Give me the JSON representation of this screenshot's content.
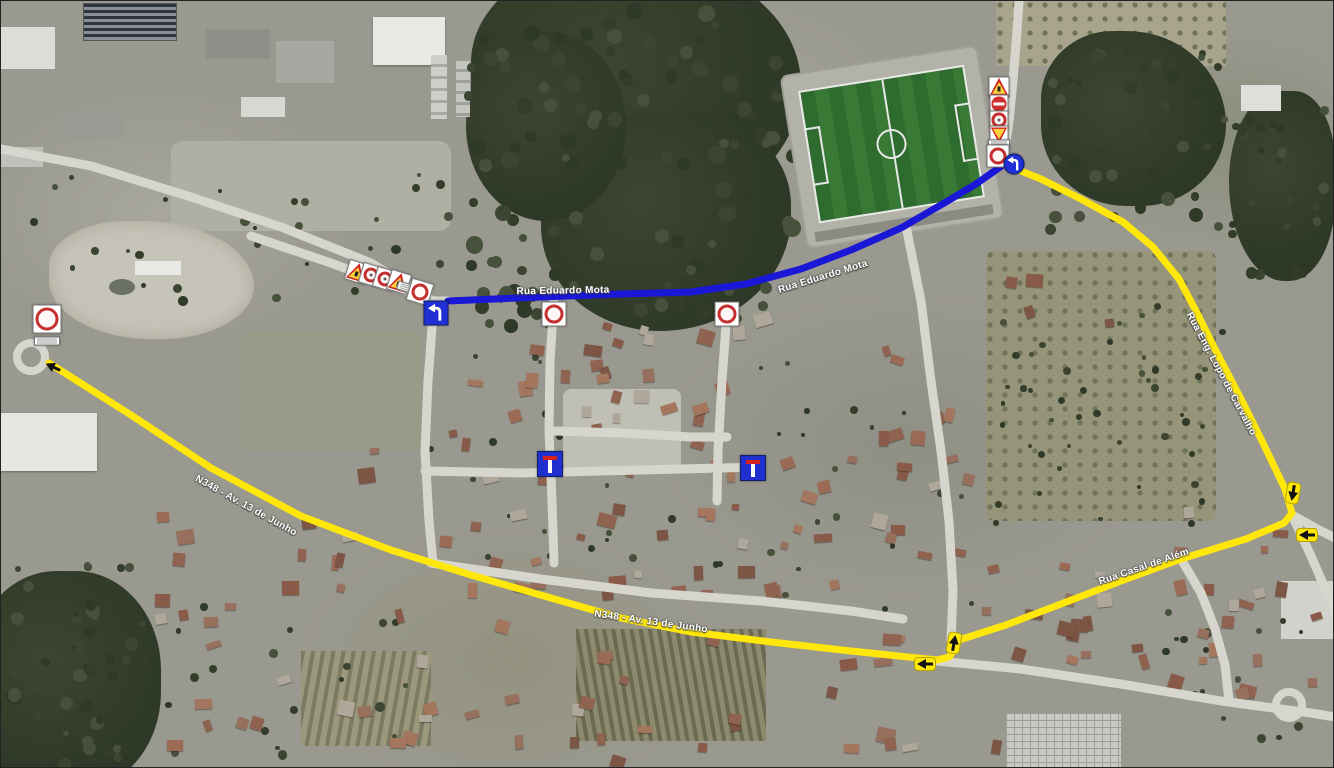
{
  "map": {
    "kind": "aerial-road-detour-map",
    "colors": {
      "closed_route": "#1a17d6",
      "detour_route": "#ffe70c",
      "road": "#d6d6cf",
      "label_text": "#ffffff"
    },
    "road_labels": [
      {
        "id": "label-rua-eduardo-mota-1",
        "text": "Rua Eduardo Mota",
        "x": 562,
        "y": 290,
        "rot": -1
      },
      {
        "id": "label-rua-eduardo-mota-2",
        "text": "Rua Eduardo Mota",
        "x": 822,
        "y": 276,
        "rot": -17
      },
      {
        "id": "label-n348-av-13-de-junho-1",
        "text": "N348 - Av. 13 de Junho",
        "x": 245,
        "y": 505,
        "rot": 29
      },
      {
        "id": "label-n348-av-13-de-junho-2",
        "text": "N348 - Av. 13 de Junho",
        "x": 650,
        "y": 621,
        "rot": 8
      },
      {
        "id": "label-rua-casal-de-alem",
        "text": "Rua Casal de Além",
        "x": 1143,
        "y": 566,
        "rot": -19
      },
      {
        "id": "label-rua-eng-lopo-de-carvalho",
        "text": "Rua Eng. Lopo de Carvalho",
        "x": 1220,
        "y": 373,
        "rot": 62
      }
    ],
    "routes": {
      "closed": {
        "name": "closed-route-line",
        "color": "#1a17d6",
        "width": 7,
        "points": [
          [
            447,
            300
          ],
          [
            540,
            296
          ],
          [
            620,
            293
          ],
          [
            690,
            291
          ],
          [
            745,
            283
          ],
          [
            800,
            268
          ],
          [
            850,
            249
          ],
          [
            900,
            227
          ],
          [
            945,
            201
          ],
          [
            975,
            183
          ],
          [
            1002,
            164
          ]
        ]
      },
      "detour": {
        "name": "detour-route-line",
        "color": "#ffe70c",
        "width": 7,
        "points": [
          [
            48,
            362
          ],
          [
            130,
            414
          ],
          [
            210,
            467
          ],
          [
            300,
            515
          ],
          [
            390,
            549
          ],
          [
            470,
            574
          ],
          [
            550,
            597
          ],
          [
            620,
            617
          ],
          [
            690,
            631
          ],
          [
            770,
            641
          ],
          [
            850,
            650
          ],
          [
            936,
            659
          ],
          [
            948,
            656
          ],
          [
            955,
            647
          ],
          [
            958,
            639
          ],
          [
            1005,
            624
          ],
          [
            1060,
            603
          ],
          [
            1120,
            580
          ],
          [
            1180,
            558
          ],
          [
            1245,
            538
          ],
          [
            1283,
            522
          ],
          [
            1291,
            512
          ],
          [
            1284,
            488
          ],
          [
            1262,
            442
          ],
          [
            1240,
            398
          ],
          [
            1215,
            350
          ],
          [
            1195,
            310
          ],
          [
            1178,
            278
          ],
          [
            1152,
            246
          ],
          [
            1122,
            221
          ],
          [
            1080,
            198
          ],
          [
            1040,
            178
          ],
          [
            1010,
            166
          ]
        ]
      }
    },
    "roads": [
      [
        [
          250,
          235
        ],
        [
          330,
          262
        ],
        [
          432,
          300
        ],
        [
          447,
          300
        ]
      ],
      [
        [
          936,
          660
        ],
        [
          1020,
          668
        ],
        [
          1120,
          683
        ],
        [
          1220,
          700
        ],
        [
          1310,
          712
        ],
        [
          1334,
          716
        ]
      ],
      [
        [
          1002,
          164
        ],
        [
          1008,
          120
        ],
        [
          1012,
          80
        ],
        [
          1016,
          30
        ],
        [
          1018,
          0
        ]
      ],
      [
        [
          1291,
          514
        ],
        [
          1310,
          555
        ],
        [
          1326,
          592
        ],
        [
          1334,
          610
        ]
      ],
      [
        [
          1291,
          514
        ],
        [
          1320,
          530
        ],
        [
          1334,
          537
        ]
      ],
      [
        [
          433,
          300
        ],
        [
          427,
          380
        ],
        [
          424,
          450
        ],
        [
          428,
          520
        ],
        [
          432,
          562
        ]
      ],
      [
        [
          553,
          298
        ],
        [
          549,
          360
        ],
        [
          548,
          430
        ],
        [
          551,
          500
        ],
        [
          553,
          562
        ]
      ],
      [
        [
          726,
          310
        ],
        [
          721,
          380
        ],
        [
          717,
          450
        ],
        [
          716,
          500
        ]
      ],
      [
        [
          424,
          470
        ],
        [
          520,
          472
        ],
        [
          600,
          470
        ],
        [
          680,
          468
        ],
        [
          760,
          466
        ]
      ],
      [
        [
          430,
          562
        ],
        [
          540,
          578
        ],
        [
          650,
          592
        ],
        [
          760,
          600
        ],
        [
          850,
          610
        ],
        [
          902,
          618
        ]
      ],
      [
        [
          905,
          225
        ],
        [
          920,
          300
        ],
        [
          930,
          380
        ],
        [
          940,
          450
        ],
        [
          948,
          520
        ],
        [
          952,
          590
        ],
        [
          950,
          640
        ]
      ],
      [
        [
          0,
          148
        ],
        [
          90,
          165
        ],
        [
          190,
          196
        ],
        [
          280,
          226
        ],
        [
          370,
          262
        ],
        [
          432,
          300
        ]
      ],
      [
        [
          553,
          430
        ],
        [
          620,
          432
        ],
        [
          690,
          436
        ],
        [
          726,
          436
        ]
      ],
      [
        [
          1180,
          558
        ],
        [
          1200,
          592
        ],
        [
          1214,
          628
        ],
        [
          1224,
          664
        ],
        [
          1228,
          700
        ]
      ]
    ],
    "roundabouts": [
      {
        "x": 30,
        "y": 356,
        "r": 14
      },
      {
        "x": 1288,
        "y": 704,
        "r": 13
      }
    ],
    "signs": [
      {
        "type": "no-vehicles",
        "x": 46,
        "y": 318,
        "size": 27
      },
      {
        "type": "plate",
        "x": 46,
        "y": 340,
        "size": 24
      },
      {
        "type": "warning-arrow",
        "x": 356,
        "y": 271,
        "size": 19,
        "rot": 17
      },
      {
        "type": "prohibition",
        "x": 370,
        "y": 274,
        "size": 19,
        "rot": 17
      },
      {
        "type": "prohibition",
        "x": 384,
        "y": 278,
        "size": 19,
        "rot": 17
      },
      {
        "type": "warning-arrow",
        "x": 398,
        "y": 281,
        "size": 19,
        "rot": 17
      },
      {
        "type": "plate",
        "x": 407,
        "y": 287,
        "size": 20,
        "rot": 17
      },
      {
        "type": "no-vehicles",
        "x": 419,
        "y": 291,
        "size": 21,
        "rot": 17
      },
      {
        "type": "blue-turn-square",
        "x": 435,
        "y": 312,
        "size": 23
      },
      {
        "type": "no-vehicles",
        "x": 553,
        "y": 313,
        "size": 23
      },
      {
        "type": "no-vehicles",
        "x": 726,
        "y": 313,
        "size": 23
      },
      {
        "type": "dead-end",
        "x": 549,
        "y": 463,
        "size": 24
      },
      {
        "type": "dead-end",
        "x": 752,
        "y": 467,
        "size": 24
      },
      {
        "type": "warning-glyph",
        "x": 998,
        "y": 86,
        "size": 19
      },
      {
        "type": "no-entry-bar",
        "x": 998,
        "y": 103,
        "size": 17
      },
      {
        "type": "prohibition",
        "x": 998,
        "y": 119,
        "size": 17
      },
      {
        "type": "yield",
        "x": 998,
        "y": 134,
        "size": 17
      },
      {
        "type": "plate",
        "x": 998,
        "y": 143,
        "size": 20
      },
      {
        "type": "no-vehicles",
        "x": 997,
        "y": 155,
        "size": 21
      },
      {
        "type": "blue-turn-circle",
        "x": 1013,
        "y": 163,
        "size": 19
      }
    ],
    "direction_arrows": [
      {
        "x": 52,
        "y": 366,
        "rot": -155,
        "pill": false
      },
      {
        "x": 924,
        "y": 663,
        "rot": 180,
        "pill": true
      },
      {
        "x": 953,
        "y": 642,
        "rot": -80,
        "pill": true
      },
      {
        "x": 1292,
        "y": 492,
        "rot": 100,
        "pill": true
      },
      {
        "x": 1306,
        "y": 534,
        "rot": 180,
        "pill": true
      }
    ]
  }
}
